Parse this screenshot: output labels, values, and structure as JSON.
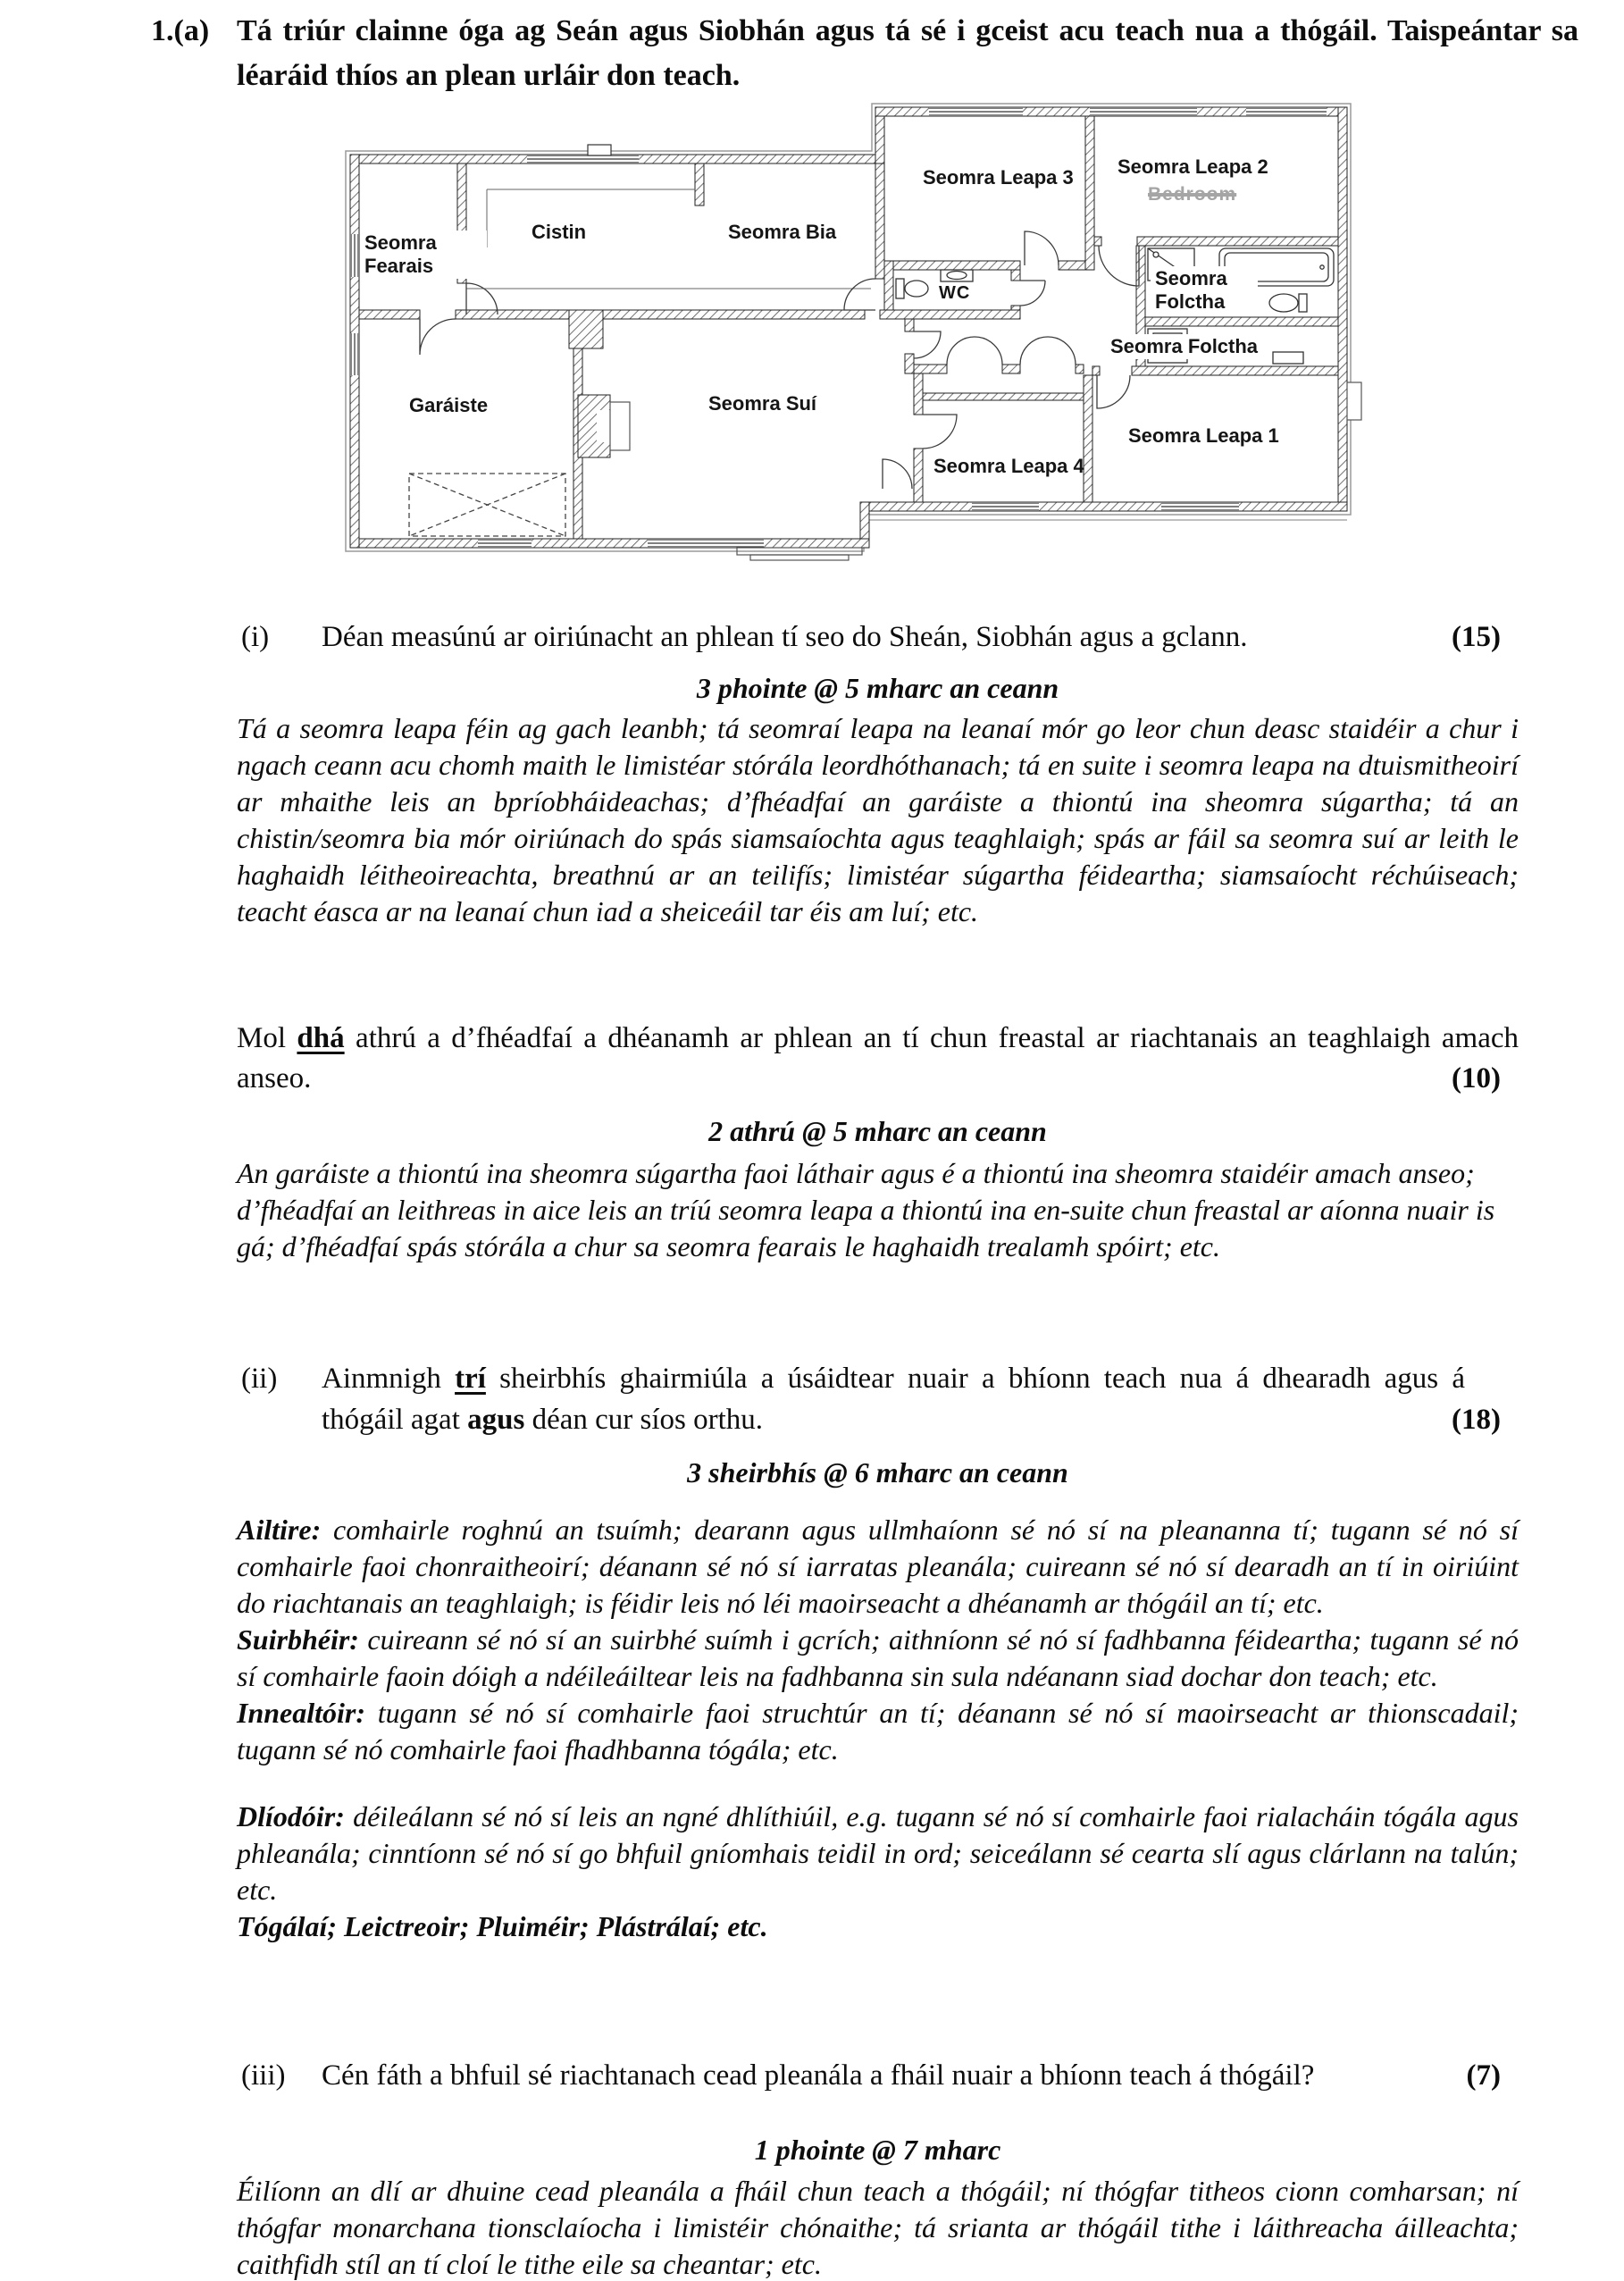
{
  "header": {
    "number": "1.(a)",
    "text": "Tá triúr clainne óga ag Seán agus Siobhán agus tá sé i gceist acu teach nua a thógáil. Taispeántar sa léaráid thíos an plean urláir don teach."
  },
  "plan": {
    "rooms": {
      "utility": "Seomra Fearais",
      "kitchen": "Cistin",
      "dining": "Seomra Bia",
      "bedroom3": "Seomra Leapa 3",
      "bedroom2": "Seomra Leapa 2",
      "bedroom2_overlay": "Bedroom",
      "wc": "WC",
      "bathroom_ensuite": "Seomra Folctha",
      "bathroom_main": "Seomra Folctha",
      "garage": "Garáiste",
      "sitting": "Seomra Suí",
      "bedroom4": "Seomra Leapa 4",
      "bedroom1": "Seomra Leapa 1"
    }
  },
  "part_i": {
    "label": "(i)",
    "question": "Déan measúnú ar oiriúnacht an phlean tí seo do Sheán, Siobhán agus a gclann.",
    "marks": "(15)",
    "scheme": "3 phointe @ 5 mharc an ceann",
    "answer": "Tá a seomra leapa féin ag gach leanbh; tá seomraí leapa na leanaí mór go leor chun deasc staidéir a chur i ngach ceann acu chomh maith le limistéar stórála leordhóthanach; tá en suite i seomra leapa na dtuismitheoirí ar mhaithe leis an bpríobháideachas; d’fhéadfaí an garáiste a thiontú ina sheomra súgartha; tá an chistin/seomra bia mór oiriúnach do spás siamsaíochta agus teaghlaigh; spás ar fáil sa seomra suí ar leith le haghaidh léitheoireachta, breathnú ar an teilifís; limistéar súgartha féideartha; siamsaíocht réchúiseach; teacht éasca ar na leanaí chun iad a sheiceáil tar éis am luí; etc."
  },
  "part_mol": {
    "pre": "Mol ",
    "emph": "dhá",
    "post": " athrú a d’fhéadfaí a dhéanamh ar phlean an tí chun freastal ar riachtanais an teaghlaigh amach anseo.",
    "marks": "(10)",
    "scheme": "2 athrú @ 5 mharc an ceann",
    "answer": "An garáiste a thiontú ina sheomra súgartha faoi láthair agus é a thiontú ina sheomra staidéir amach anseo; d’fhéadfaí an leithreas in aice leis an tríú seomra leapa a thiontú ina en-suite chun freastal ar aíonna nuair is gá; d’fhéadfaí spás stórála a chur sa seomra fearais le haghaidh trealamh spóirt; etc."
  },
  "part_ii": {
    "label": "(ii)",
    "q1": "Ainmnigh ",
    "emph": "trí",
    "q2": " sheirbhís ghairmiúla a úsáidtear nuair a bhíonn teach nua á dhearadh agus á thógáil agat ",
    "emph2": "agus",
    "q3": " déan cur síos orthu.",
    "marks": "(18)",
    "scheme": "3 sheirbhís @ 6 mharc an ceann",
    "services": [
      {
        "name": "Ailtire:",
        "desc": "comhairle roghnú an tsuímh; dearann agus ullmhaíonn sé nó sí na pleananna tí; tugann sé nó sí comhairle faoi chonraitheoirí; déanann sé nó sí iarratas pleanála; cuireann sé nó sí dearadh an tí in oiriúint do riachtanais an teaghlaigh; is féidir leis nó léi maoirseacht a dhéanamh ar thógáil an tí; etc."
      },
      {
        "name": "Suirbhéir:",
        "desc": "cuireann sé nó sí an suirbhé suímh i gcrích; aithníonn sé nó sí fadhbanna féideartha; tugann sé nó sí comhairle faoin dóigh a ndéileáiltear leis na fadhbanna sin sula ndéanann siad dochar don teach; etc."
      },
      {
        "name": "Innealtóir:",
        "desc": "tugann sé nó sí comhairle faoi struchtúr an tí; déanann sé nó sí maoirseacht ar thionscadail; tugann sé nó comhairle faoi fhadhbanna tógála; etc."
      },
      {
        "name": "Dlíodóir:",
        "desc": "déileálann sé nó sí leis an ngné dhlíthiúil, e.g. tugann sé nó sí comhairle faoi rialacháin tógála agus phleanála; cinntíonn sé nó sí go bhfuil gníomhais teidil in ord; seiceálann sé cearta slí agus clárlann na talún; etc."
      }
    ],
    "trades": "Tógálaí; Leictreoir; Pluiméir; Plástrálaí; etc."
  },
  "part_iii": {
    "label": "(iii)",
    "question": "Cén fáth a bhfuil sé riachtanach cead pleanála a fháil nuair a bhíonn teach á thógáil?",
    "marks": "(7)",
    "scheme": "1 phointe @ 7 mharc",
    "answer": "Éilíonn an dlí ar dhuine cead pleanála a fháil chun teach a thógáil; ní thógfar titheos cionn comharsan; ní thógfar monarchana tionsclaíocha i limistéir chónaithe; tá srianta ar thógáil tithe i láithreacha áilleachta; caithfidh stíl an tí cloí le tithe eile sa cheantar; etc."
  }
}
